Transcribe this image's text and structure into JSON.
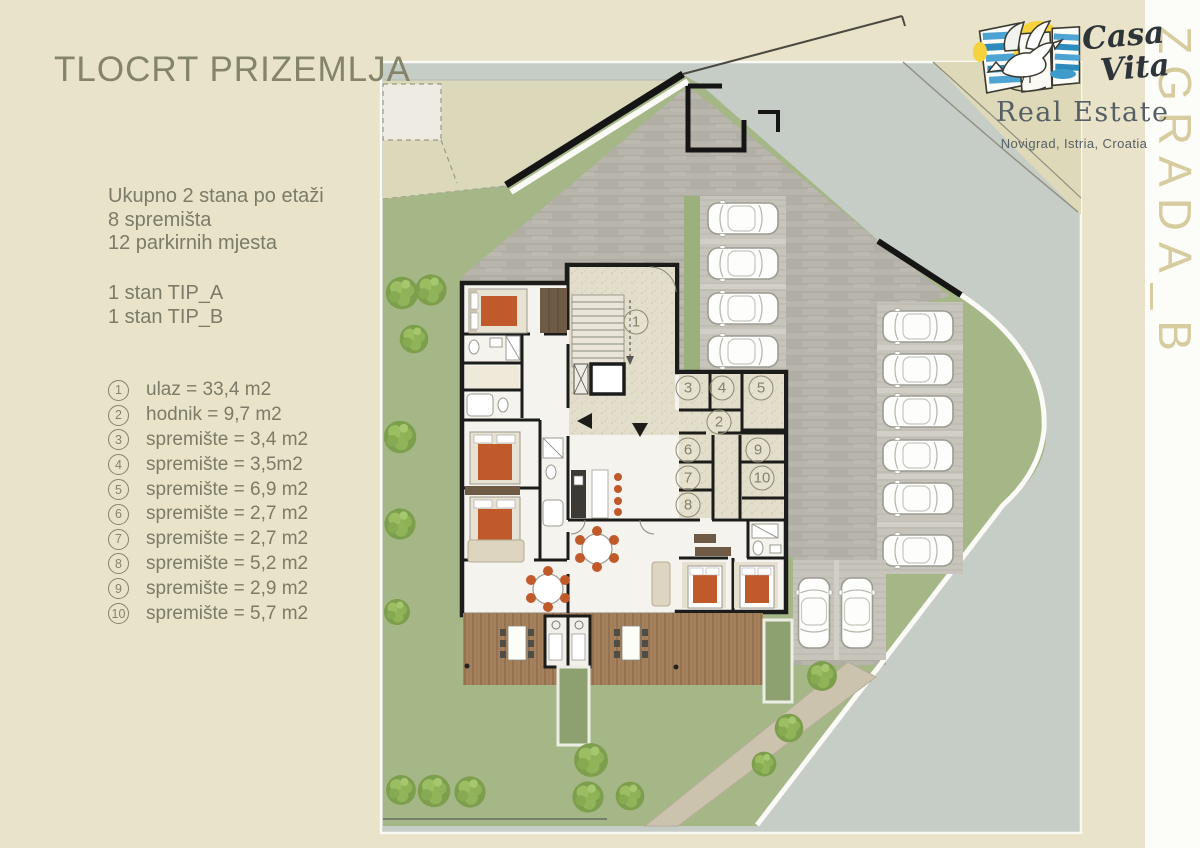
{
  "page": {
    "title": "TLOCRT PRIZEMLJA",
    "building_label": "ZGRADA_B"
  },
  "summary": {
    "lines": [
      "Ukupno 2 stana po etaži",
      "8 spremišta",
      "12 parkirnih mjesta"
    ]
  },
  "unit_types": {
    "lines": [
      "1 stan TIP_A",
      "1 stan TIP_B"
    ]
  },
  "legend": {
    "items": [
      {
        "num": "1",
        "text": "ulaz = 33,4 m2"
      },
      {
        "num": "2",
        "text": "hodnik = 9,7 m2"
      },
      {
        "num": "3",
        "text": "spremište = 3,4 m2"
      },
      {
        "num": "4",
        "text": "spremište = 3,5m2"
      },
      {
        "num": "5",
        "text": "spremište = 6,9 m2"
      },
      {
        "num": "6",
        "text": "spremište = 2,7 m2"
      },
      {
        "num": "7",
        "text": "spremište = 2,7 m2"
      },
      {
        "num": "8",
        "text": "spremište = 5,2 m2"
      },
      {
        "num": "9",
        "text": "spremište = 2,9 m2"
      },
      {
        "num": "10",
        "text": "spremište = 5,7 m2"
      }
    ]
  },
  "logo": {
    "script_line1": "Casa",
    "script_line2": "Vita",
    "name": "Real Estate",
    "location": "Novigrad, Istria, Croatia"
  },
  "plan": {
    "room_markers": [
      {
        "num": "1",
        "x": 636,
        "y": 322
      },
      {
        "num": "2",
        "x": 719,
        "y": 422
      },
      {
        "num": "3",
        "x": 688,
        "y": 388
      },
      {
        "num": "4",
        "x": 722,
        "y": 388
      },
      {
        "num": "5",
        "x": 761,
        "y": 388
      },
      {
        "num": "6",
        "x": 688,
        "y": 450
      },
      {
        "num": "7",
        "x": 688,
        "y": 478
      },
      {
        "num": "8",
        "x": 688,
        "y": 505
      },
      {
        "num": "9",
        "x": 758,
        "y": 450
      },
      {
        "num": "10",
        "x": 762,
        "y": 478
      }
    ]
  },
  "colors": {
    "page_bg": "#e9e3c9",
    "accent_text": "#84846a",
    "body_text": "#7b7b67",
    "lawn": "#a5b687",
    "road": "#c6ccc6",
    "paving": "#b8b5ad",
    "terracotta": "#c05a2b",
    "deck_wood": "#a5815e",
    "pool": "#8ca16f",
    "wall": "#1c1c1a",
    "logo_blue": "#4da4d2",
    "logo_sun": "#f6d23c",
    "label_beige": "#d7cc9f",
    "logo_text": "#566064"
  }
}
